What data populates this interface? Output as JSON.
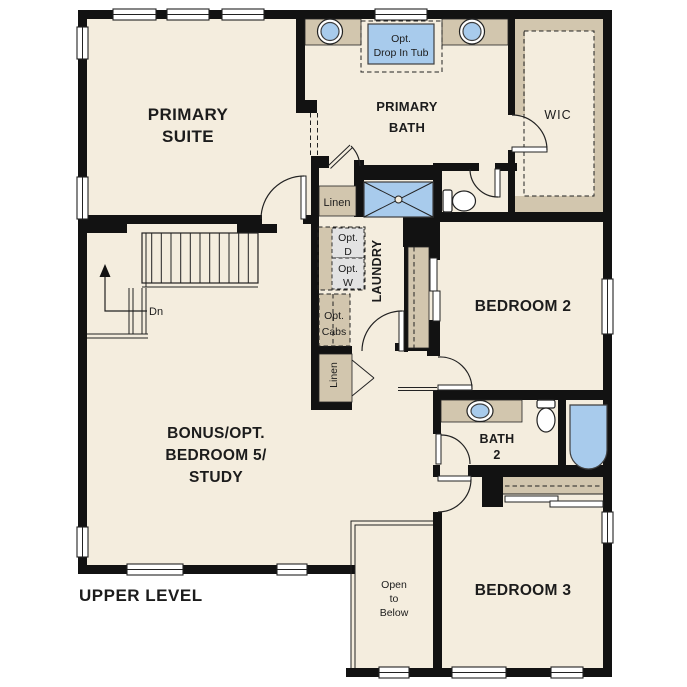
{
  "colors": {
    "paper": "#ffffff",
    "wall": "#121212",
    "floor": "#f4edde",
    "cabinet": "#d2c6ae",
    "fixture": "#a8cbec",
    "fixture_border": "#3f3f3f",
    "appliance": "#e3e3e3",
    "line": "#222222",
    "text": "#1c1c1c"
  },
  "title": {
    "label": "UPPER LEVEL"
  },
  "rooms": {
    "primary_suite": {
      "line1": "PRIMARY",
      "line2": "SUITE"
    },
    "primary_bath": {
      "line1": "PRIMARY",
      "line2": "BATH"
    },
    "wic": {
      "label": "WIC"
    },
    "laundry": {
      "label": "LAUNDRY"
    },
    "bedroom2": {
      "label": "BEDROOM 2"
    },
    "bath2": {
      "line1": "BATH",
      "line2": "2"
    },
    "bedroom3": {
      "label": "BEDROOM 3"
    },
    "bonus": {
      "line1": "BONUS/OPT.",
      "line2": "BEDROOM 5/",
      "line3": "STUDY"
    },
    "open_to_below": {
      "line1": "Open",
      "line2": "to",
      "line3": "Below"
    }
  },
  "annotations": {
    "opt_drop_in_tub": {
      "line1": "Opt.",
      "line2": "Drop In Tub"
    },
    "linen_upper": {
      "label": "Linen"
    },
    "linen_lower": {
      "label": "Linen"
    },
    "opt_dryer": {
      "line1": "Opt.",
      "line2": "D"
    },
    "opt_washer": {
      "line1": "Opt.",
      "line2": "W"
    },
    "opt_cabs": {
      "line1": "Opt.",
      "line2": "Cabs"
    },
    "stairs": {
      "down_label": "Dn"
    }
  }
}
